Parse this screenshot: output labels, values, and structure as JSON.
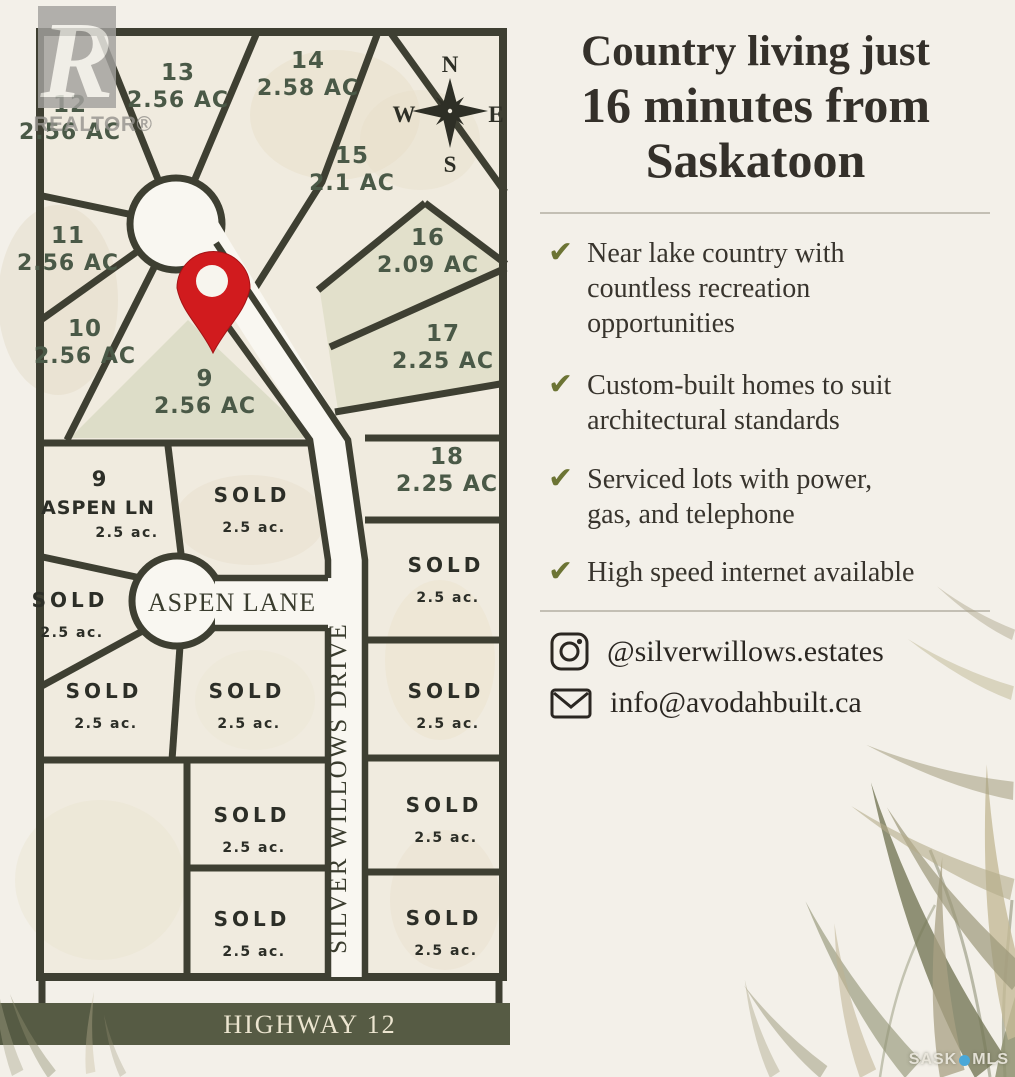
{
  "panel": {
    "headline_lines": [
      "Country living just",
      "16 minutes from",
      "Saskatoon"
    ],
    "check_glyph": "✔",
    "bullets": [
      {
        "lines": [
          "Near lake country with",
          "countless recreation",
          "opportunities"
        ]
      },
      {
        "lines": [
          "Custom-built homes to suit",
          "architectural standards"
        ]
      },
      {
        "lines": [
          "Serviced lots with power,",
          "gas, and telephone"
        ]
      },
      {
        "lines": [
          "High speed internet available"
        ]
      }
    ],
    "contact": {
      "instagram": "@silverwillows.estates",
      "email": "info@avodahbuilt.ca"
    }
  },
  "map": {
    "compass": {
      "n": "N",
      "e": "E",
      "s": "S",
      "w": "W"
    },
    "streets": {
      "aspen_lane": "ASPEN LANE",
      "silver_willows_drive": "SILVER WILLOWS DRIVE",
      "highway": "HIGHWAY 12"
    },
    "aspen_corner_lot": {
      "number": "9",
      "street": "ASPEN LN",
      "acreage": "2.5 ac."
    },
    "numbered_lots": [
      {
        "number": "13",
        "acreage": "2.56 AC",
        "x": 178,
        "y": 80
      },
      {
        "number": "14",
        "acreage": "2.58 AC",
        "x": 308,
        "y": 68
      },
      {
        "number": "12",
        "acreage": "2.56 AC",
        "x": 70,
        "y": 112
      },
      {
        "number": "15",
        "acreage": "2.1 AC",
        "x": 352,
        "y": 163
      },
      {
        "number": "11",
        "acreage": "2.56 AC",
        "x": 68,
        "y": 243
      },
      {
        "number": "16",
        "acreage": "2.09 AC",
        "x": 428,
        "y": 245
      },
      {
        "number": "10",
        "acreage": "2.56 AC",
        "x": 85,
        "y": 336
      },
      {
        "number": "17",
        "acreage": "2.25 AC",
        "x": 443,
        "y": 341
      },
      {
        "number": "9",
        "acreage": "2.56 AC",
        "x": 205,
        "y": 386
      },
      {
        "number": "18",
        "acreage": "2.25 AC",
        "x": 447,
        "y": 464
      }
    ],
    "sold_lots": [
      {
        "label": "SOLD",
        "acreage": "2.5 ac.",
        "x": 252,
        "y": 502
      },
      {
        "label": "SOLD",
        "acreage": "2.5 ac.",
        "x": 70,
        "y": 607
      },
      {
        "label": "SOLD",
        "acreage": "2.5 ac.",
        "x": 104,
        "y": 698
      },
      {
        "label": "SOLD",
        "acreage": "2.5 ac.",
        "x": 247,
        "y": 698
      },
      {
        "label": "SOLD",
        "acreage": "2.5 ac.",
        "x": 252,
        "y": 822
      },
      {
        "label": "SOLD",
        "acreage": "2.5 ac.",
        "x": 252,
        "y": 926
      },
      {
        "label": "SOLD",
        "acreage": "2.5 ac.",
        "x": 446,
        "y": 572
      },
      {
        "label": "SOLD",
        "acreage": "2.5 ac.",
        "x": 446,
        "y": 698
      },
      {
        "label": "SOLD",
        "acreage": "2.5 ac.",
        "x": 444,
        "y": 812
      },
      {
        "label": "SOLD",
        "acreage": "2.5 ac.",
        "x": 444,
        "y": 925
      }
    ]
  },
  "watermarks": {
    "realtor_letter": "R",
    "realtor_label": "REALTOR®",
    "listing_left": "SASK",
    "listing_right": "MLS"
  },
  "colors": {
    "line_dark": "#3e3f32",
    "lot_green": "#4a5947",
    "sold_dark": "#2c2e27",
    "pin_red": "#d11b1e",
    "check_olive": "#6c7434",
    "highway_band": "#565b44",
    "headline_ink": "#34302a",
    "road_white": "#f9f7f1",
    "map_cream": "#f0ebdf",
    "page_bg": "#f3f0e9"
  }
}
